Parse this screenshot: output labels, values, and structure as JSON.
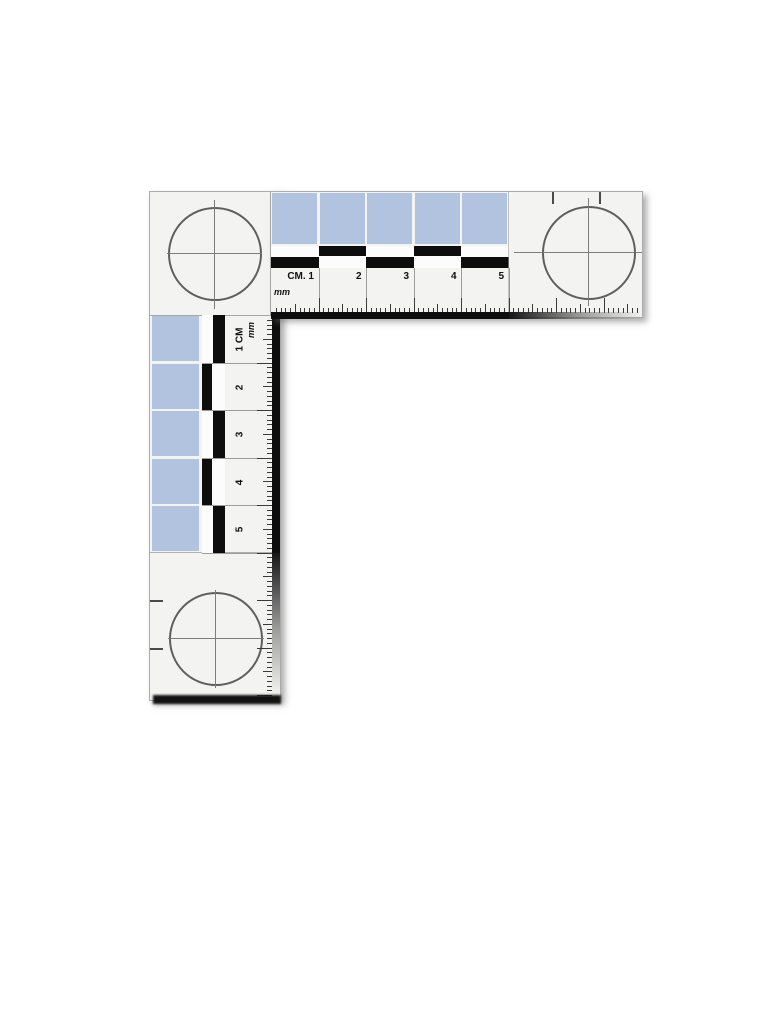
{
  "page": {
    "background": "#ffffff"
  },
  "scale": {
    "body_color": "#f3f3f1",
    "accent_blue": "#b2c3e0",
    "bar_black": "#0d0d0d",
    "horizontal_arm": {
      "cm_labels": [
        "CM. 1",
        "2",
        "3",
        "4",
        "5"
      ],
      "mm_label": "mm",
      "blue_squares": 5,
      "edge_cm_ticks": 2
    },
    "vertical_arm": {
      "cm_labels": [
        "1 CM",
        "2",
        "3",
        "4",
        "5"
      ],
      "mm_label": "mm",
      "blue_squares": 5,
      "edge_cm_ticks": 2
    },
    "fiducial_targets": {
      "count": 3,
      "shape": "circle-crosshair"
    }
  }
}
